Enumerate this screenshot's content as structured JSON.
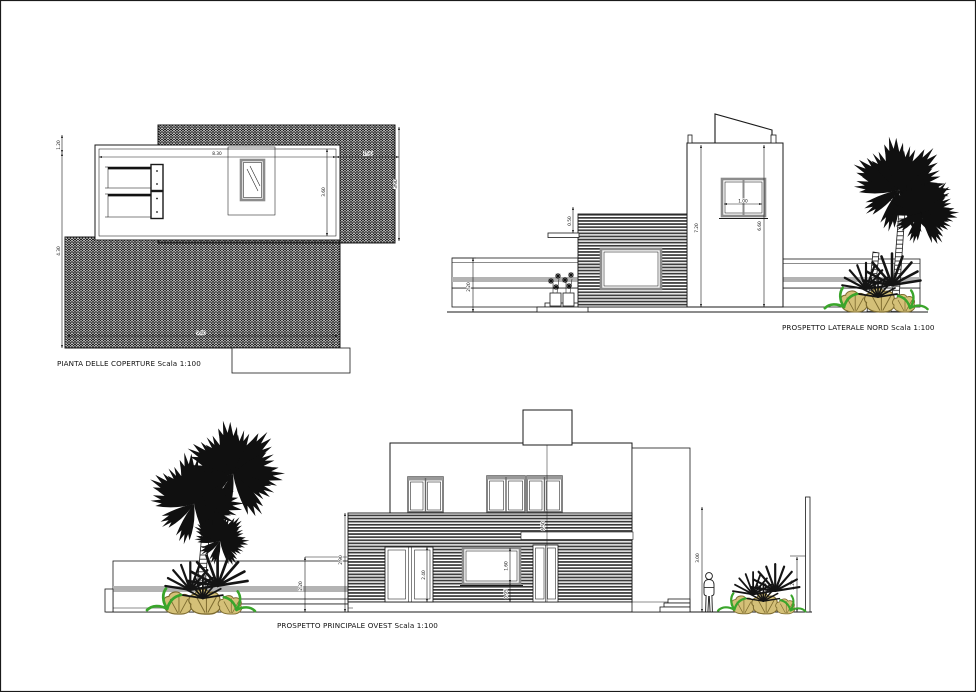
{
  "sheet": {
    "background": "#ffffff",
    "border_color": "#1a1a1a"
  },
  "colors": {
    "ink": "#1a1a1a",
    "cladding_dark": "#3a3a3a",
    "wall_stripe_gray": "#b3b3b3",
    "window_frame_gray": "#8c8c8c",
    "plant_green": "#3aa52b",
    "bush_tan": "#d4c078",
    "bush_outline": "#7c6a2e"
  },
  "views": {
    "roof_plan": {
      "title": "PIANTA DELLE COPERTURE Scala 1:100",
      "dimensions": {
        "top_width": "8.30",
        "top_right_width": "1.90",
        "left_upper": "1.20",
        "left_lower": "4.30",
        "roof_depth": "3.60",
        "terrace_depth": "3.90",
        "bottom_width": "9.40"
      }
    },
    "north_elevation": {
      "title": "PROSPETTO LATERALE NORD Scala 1:100",
      "dimensions": {
        "boundary_wall_height": "2.20",
        "parapet_height": "0.50",
        "total_height": "7.20",
        "tower_height": "6.60",
        "window_width": "1.00"
      }
    },
    "west_elevation": {
      "title": "PROSPETTO PRINCIPALE OVEST Scala 1:100",
      "dimensions": {
        "boundary_wall_height": "2.20",
        "cladding_height": "2.90",
        "door_height": "2.40",
        "window_height": "1.60",
        "sill_height": "0.95",
        "building_height": "6.50",
        "right_height": "3.00",
        "right_wall_height": "2.20"
      }
    }
  }
}
